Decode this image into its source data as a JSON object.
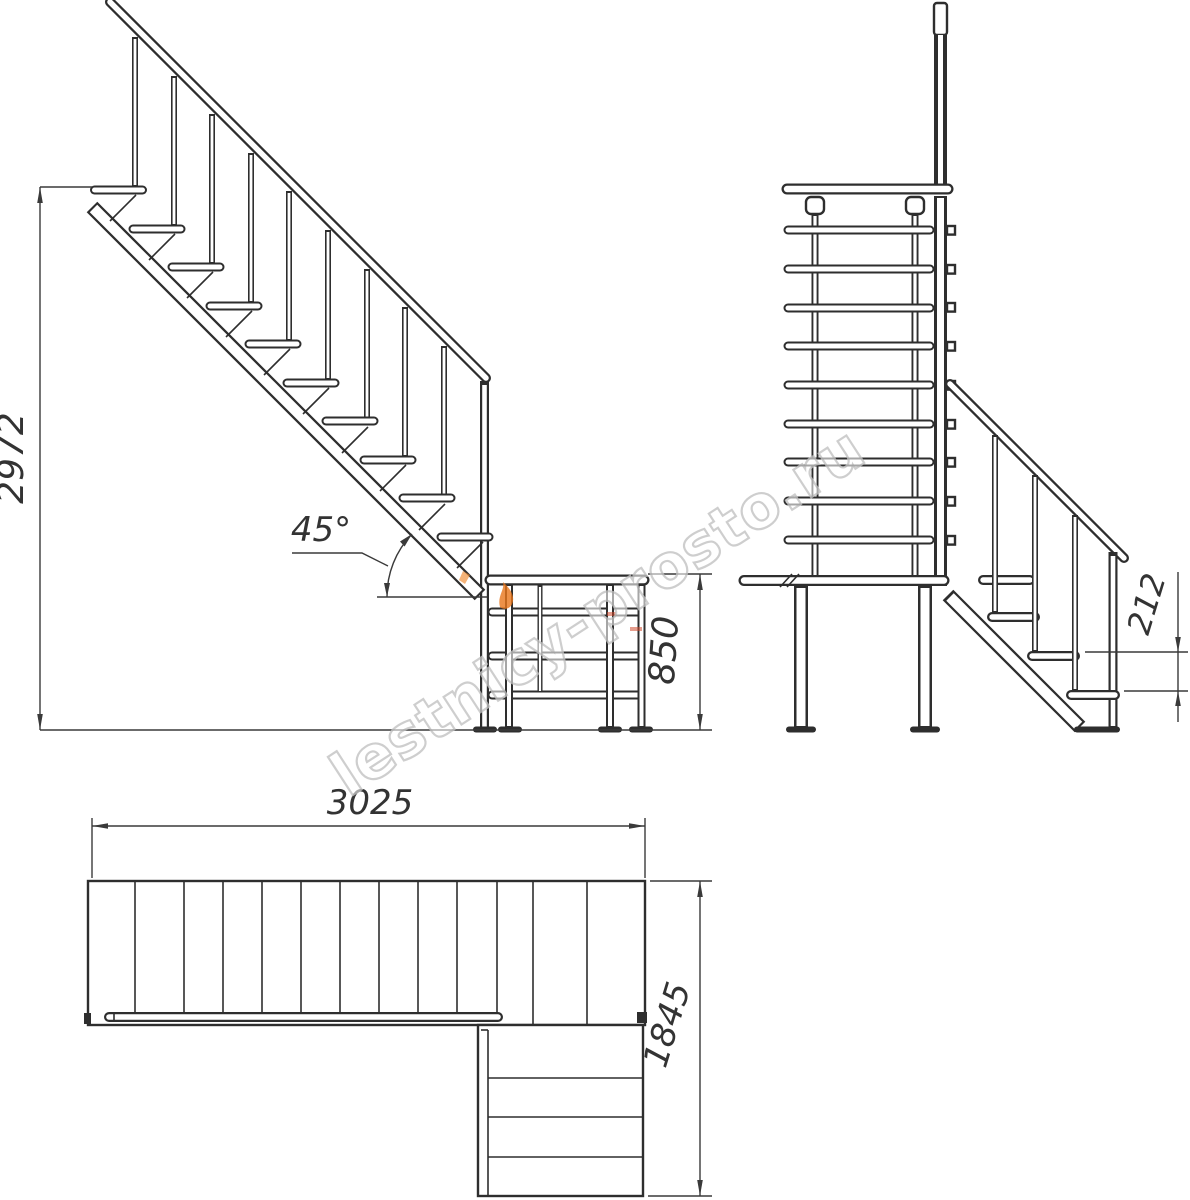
{
  "page": {
    "background": "#ffffff"
  },
  "drawing": {
    "type": "stair-assembly-technical-drawing",
    "line_color": "#2e2e2e",
    "dim_color": "#3a3a3a",
    "views": {
      "side_elevation": {
        "name": "side elevation of upper flight with platform railing",
        "dim_total_height": "2972",
        "dim_angle": "45°",
        "dim_rail_height": "850"
      },
      "front_elevation": {
        "name": "front elevation with lower flight",
        "dim_step_rise": "212"
      },
      "plan": {
        "name": "plan view",
        "dim_length": "3025",
        "dim_width": "1845"
      }
    },
    "watermark": {
      "text": "lestnicy-prosto.ru",
      "outline_color": "#c3c3c3",
      "accent_color": "#e8751a",
      "accent2_color": "#cf4a2e"
    }
  }
}
